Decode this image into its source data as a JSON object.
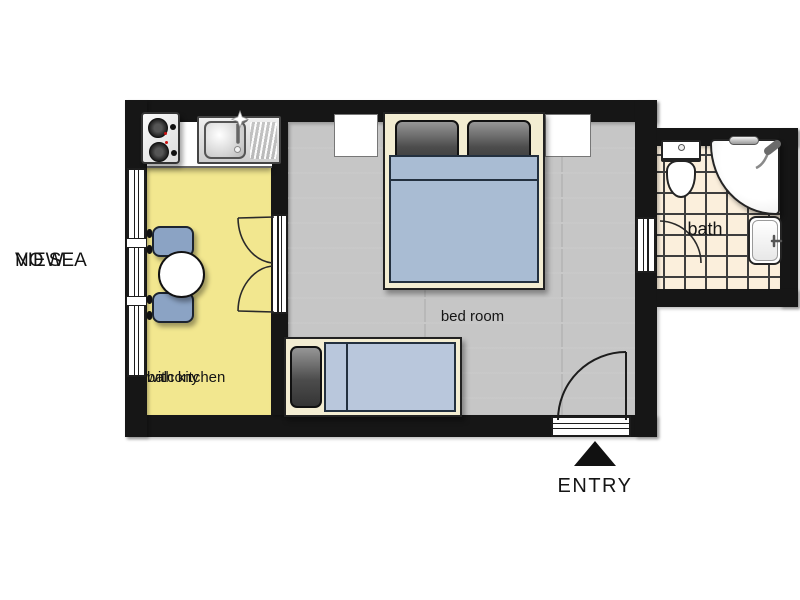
{
  "plan": {
    "type": "apartment floor plan",
    "annotations": {
      "no_sea_view": [
        "NO SEA",
        "VIEW"
      ],
      "balcony": [
        "balcony",
        "with kitchen"
      ],
      "bedroom": "bed room",
      "bath": "bath",
      "entry": "ENTRY"
    },
    "rooms": [
      {
        "name": "balcony with kitchen",
        "floor": "yellow"
      },
      {
        "name": "bed room",
        "floor": "gray wood planks"
      },
      {
        "name": "bath",
        "floor": "cream tiles"
      }
    ],
    "fixtures": [
      "stove-icon",
      "kitchen-sink-icon",
      "dining-table-icon",
      "chair-icon",
      "window-icon",
      "french-door-icon",
      "double-bed-icon",
      "pillow-icon",
      "nightstand-icon",
      "single-bed-icon",
      "bath-door-icon",
      "entry-door-icon",
      "toilet-icon",
      "corner-tub-shower-icon",
      "washbasin-icon",
      "grab-bar-icon",
      "entry-arrow-icon"
    ],
    "colors": {
      "wall": "#161616",
      "balcony": "#F2E78F",
      "wood": "#C6C6C6",
      "woodline": "#9C9C9C",
      "tile": "#FBEFDC",
      "tileline": "#3E3E3E",
      "blue": "#A9BCD3",
      "lightblue": "#B9C7DC",
      "chairblue": "#8BA3C4",
      "cream": "#F3EDD2",
      "pillow": "#4A4A4A",
      "white": "#FFFFFF",
      "text": "#151515",
      "red": "#CC1111"
    }
  }
}
